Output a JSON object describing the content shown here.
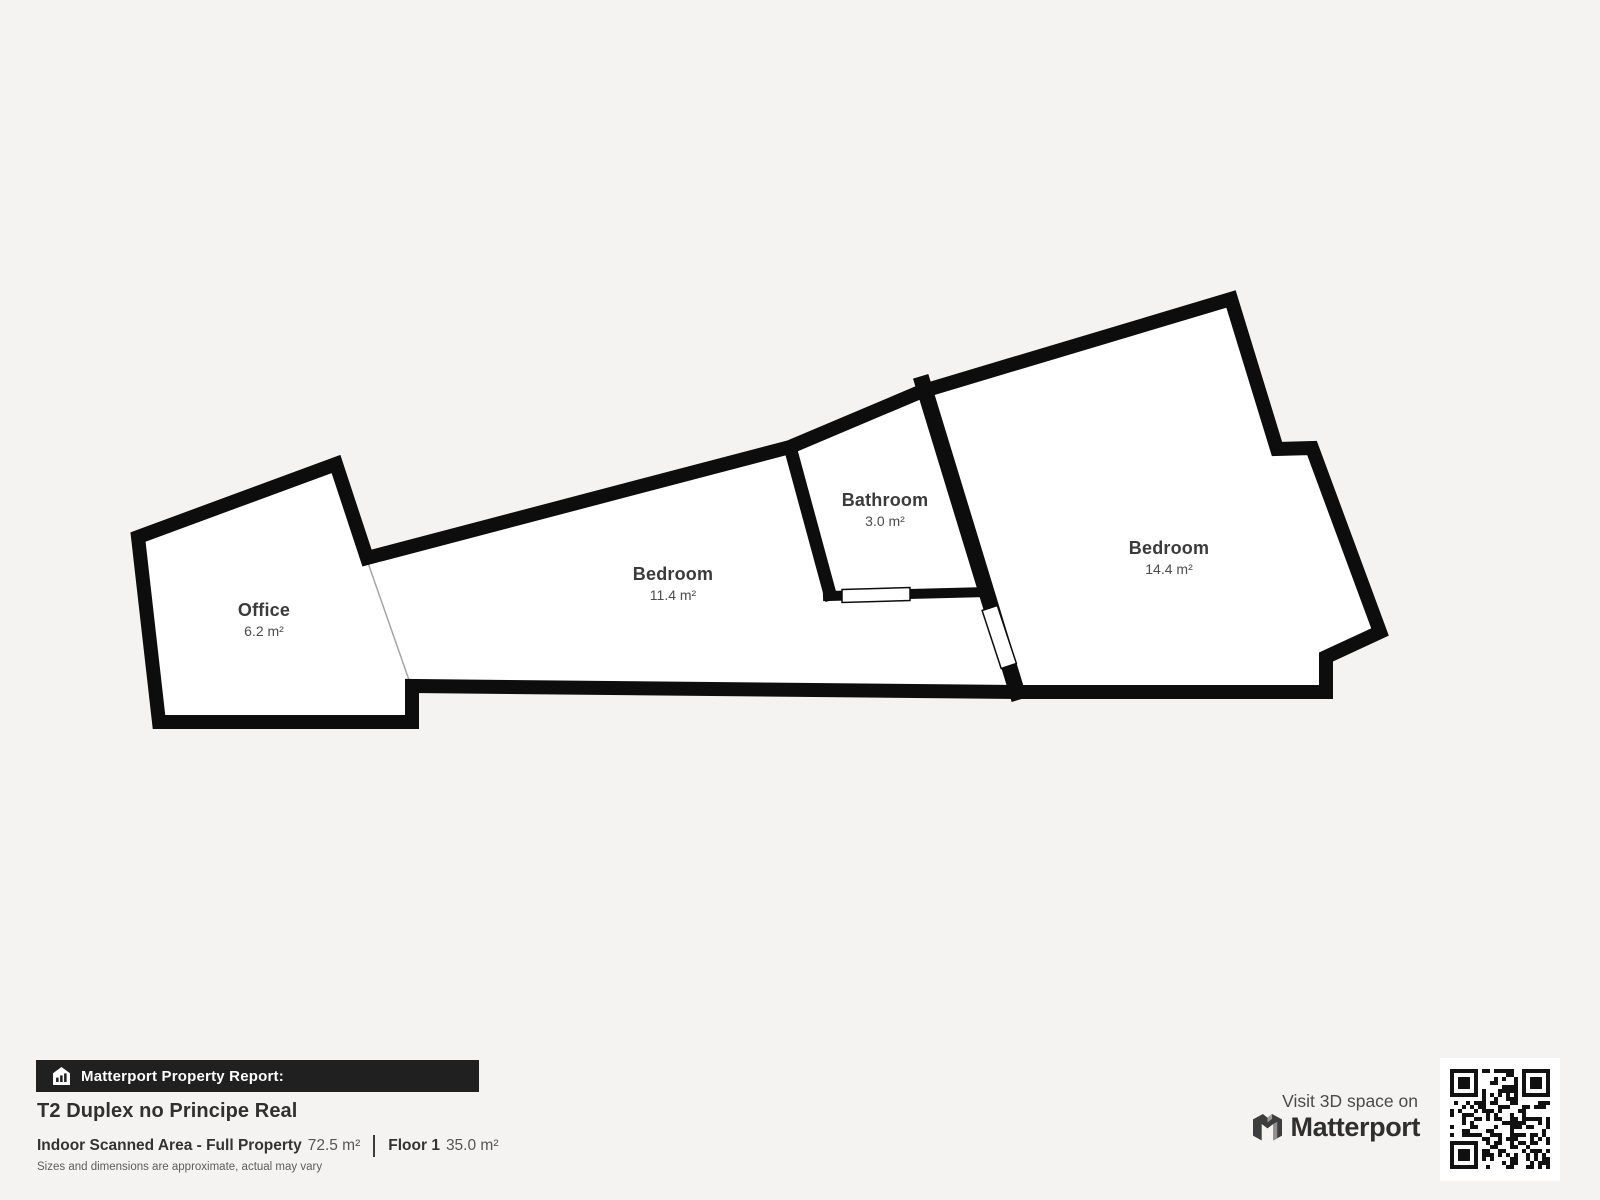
{
  "colors": {
    "background": "#f4f3f1",
    "wall": "#0d0d0d",
    "room_fill": "#ffffff",
    "banner_bg": "#202020"
  },
  "plan": {
    "rooms": [
      {
        "name": "Office",
        "area": "6.2 m²"
      },
      {
        "name": "Bedroom",
        "area": "11.4 m²"
      },
      {
        "name": "Bathroom",
        "area": "3.0 m²"
      },
      {
        "name": "Bedroom",
        "area": "14.4 m²"
      }
    ]
  },
  "footer": {
    "banner_label": "Matterport Property Report:",
    "title": "T2 Duplex no Principe Real",
    "scanned_label": "Indoor Scanned Area - Full Property",
    "scanned_value": "72.5 m²",
    "floor_label": "Floor 1",
    "floor_value": "35.0 m²",
    "disclaimer": "Sizes and dimensions are approximate, actual may vary"
  },
  "cta": {
    "visit_text": "Visit 3D space on",
    "brand": "Matterport",
    "icons": [
      "matterport-m-icon",
      "qr-code",
      "house-report-icon"
    ]
  }
}
